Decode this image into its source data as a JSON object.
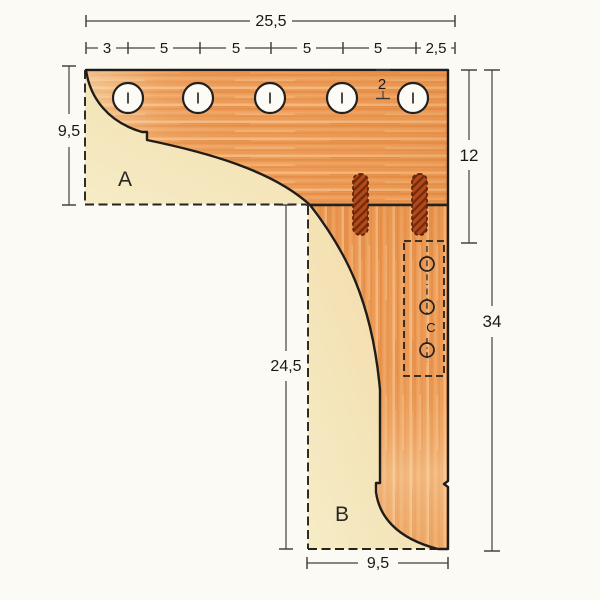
{
  "diagram": {
    "type": "woodworking-corner-bracket-plan",
    "parts": {
      "a": "A",
      "b": "B",
      "c": "C"
    },
    "dims": {
      "overall_width": "25,5",
      "segments": [
        "3",
        "5",
        "5",
        "5",
        "5",
        "2,5"
      ],
      "left_height": "9,5",
      "hole_offset": "2",
      "upper_right_height": "12",
      "overall_height": "34",
      "lower_left_height": "24,5",
      "bottom_width": "9,5"
    },
    "colors": {
      "wood_base": "#ec9b57",
      "wood_light": "#f8c28c",
      "wood_dark": "#d97c33",
      "panel_cream": "#f5ecc6",
      "slot_fill": "#b24a1a",
      "slot_hatch": "#6e2406",
      "outline": "#201d18",
      "dimension": "#44403a",
      "background": "#fcfaf5"
    }
  }
}
